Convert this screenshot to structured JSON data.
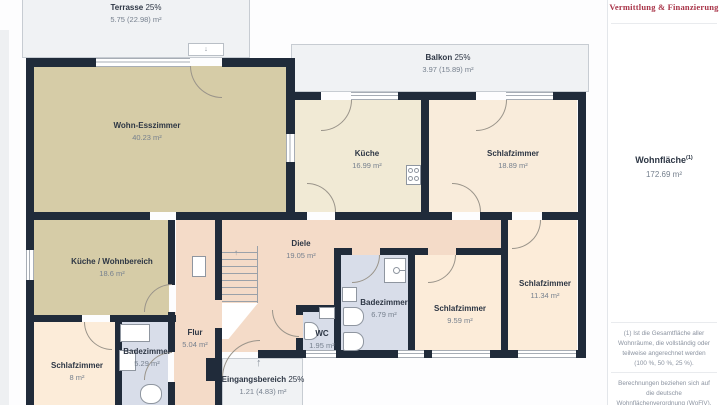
{
  "header": {
    "logo_text": "Vermittlung & Finanzierung"
  },
  "sidebar": {
    "living_area_label": "Wohnfläche",
    "living_area_footnote_marker": "(1)",
    "living_area_value": "172.69 m²",
    "footnote_1": "(1) Ist die Gesamtfläche aller Wohnräume, die vollständig oder teilweise angerechnet werden (100 %, 50 %, 25 %).",
    "footnote_2": "Berechnungen beziehen sich auf die deutsche Wohnflächenverordnung (WoFlV). Maße sind ungefähre Angaben"
  },
  "floorplan": {
    "rooms": [
      {
        "name": "Terrasse",
        "percent": "25%",
        "area": "5.75 (22.98) m²"
      },
      {
        "name": "Balkon",
        "percent": "25%",
        "area": "3.97 (15.89) m²"
      },
      {
        "name": "Wohn-Esszimmer",
        "area": "40.23 m²"
      },
      {
        "name": "Küche",
        "area": "16.99 m²"
      },
      {
        "name": "Schlafzimmer",
        "area": "18.89 m²"
      },
      {
        "name": "Diele",
        "area": "19.05 m²"
      },
      {
        "name": "Küche / Wohnbereich",
        "area": "18.6 m²"
      },
      {
        "name": "Badezimmer",
        "area": "6.79 m²"
      },
      {
        "name": "Schlafzimmer",
        "area": "9.59 m²"
      },
      {
        "name": "Schlafzimmer",
        "area": "11.34 m²"
      },
      {
        "name": "WC",
        "area": "1.95 m²"
      },
      {
        "name": "Flur",
        "area": "5.04 m²"
      },
      {
        "name": "Badezimmer",
        "area": "5.29 m²"
      },
      {
        "name": "Schlafzimmer",
        "area": "8 m²"
      },
      {
        "name": "Eingangsbereich",
        "percent": "25%",
        "area": "1.21 (4.83) m²"
      }
    ],
    "stair_direction_arrow": "↑",
    "entrance_arrow": "↑",
    "terrace_door_arrow": "↓"
  },
  "colors": {
    "wall": "#202b3a",
    "logo_red": "#a93549",
    "room_beige": "#d6cca7",
    "room_cream": "#f1ead5",
    "room_peach": "#fcecd9",
    "room_salmon": "#f4dbc8",
    "room_blue": "#d8dde9",
    "outdoor_gray": "#f0f2f4"
  }
}
